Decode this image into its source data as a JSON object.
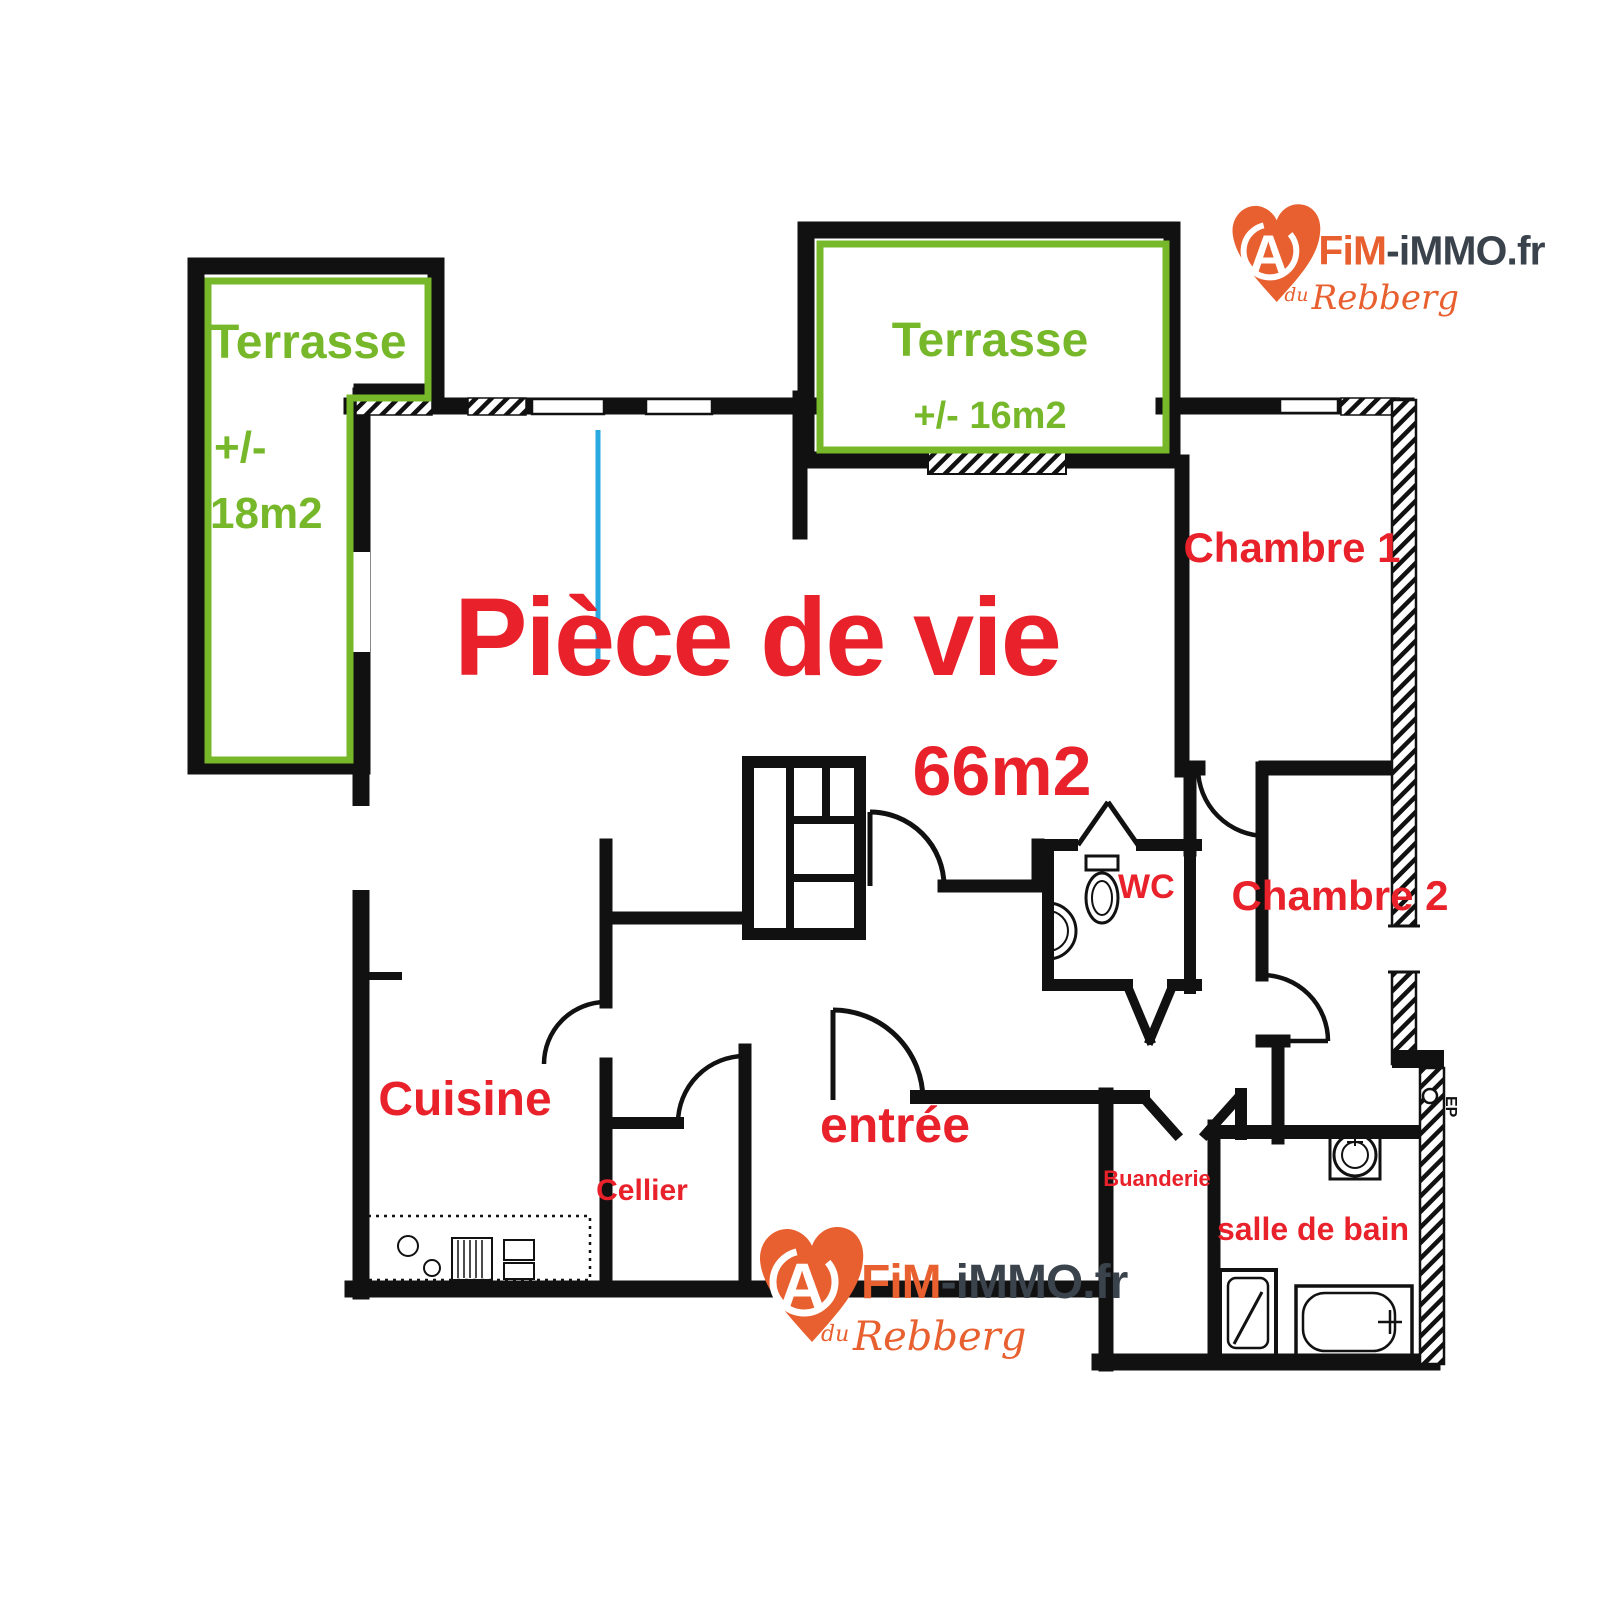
{
  "colors": {
    "wall": "#111111",
    "red_label": "#e8212a",
    "green_label": "#76b82a",
    "blue_line": "#2aa9e1",
    "logo_orange": "#e8602f",
    "logo_dark": "#3a424c"
  },
  "rooms": {
    "terrace1": {
      "name": "Terrasse",
      "approx": "+/-",
      "area": "18m2"
    },
    "terrace2": {
      "name": "Terrasse",
      "area": "+/- 16m2"
    },
    "living": {
      "name": "Pièce de vie",
      "area": "66m2"
    },
    "bedroom1": {
      "name": "Chambre 1"
    },
    "bedroom2": {
      "name": "Chambre 2"
    },
    "wc": {
      "name": "WC"
    },
    "kitchen": {
      "name": "Cuisine"
    },
    "pantry": {
      "name": "Cellier"
    },
    "entry": {
      "name": "entrée"
    },
    "laundry": {
      "name": "Buanderie"
    },
    "bathroom": {
      "name": "salle de bain"
    }
  },
  "annotation": {
    "ep": "EP"
  },
  "logo": {
    "heart_letter": "A",
    "brand_orange": "FiM",
    "brand_dark": "-iMMO.fr",
    "tagline_du": "du",
    "tagline_name": "Rebberg"
  }
}
